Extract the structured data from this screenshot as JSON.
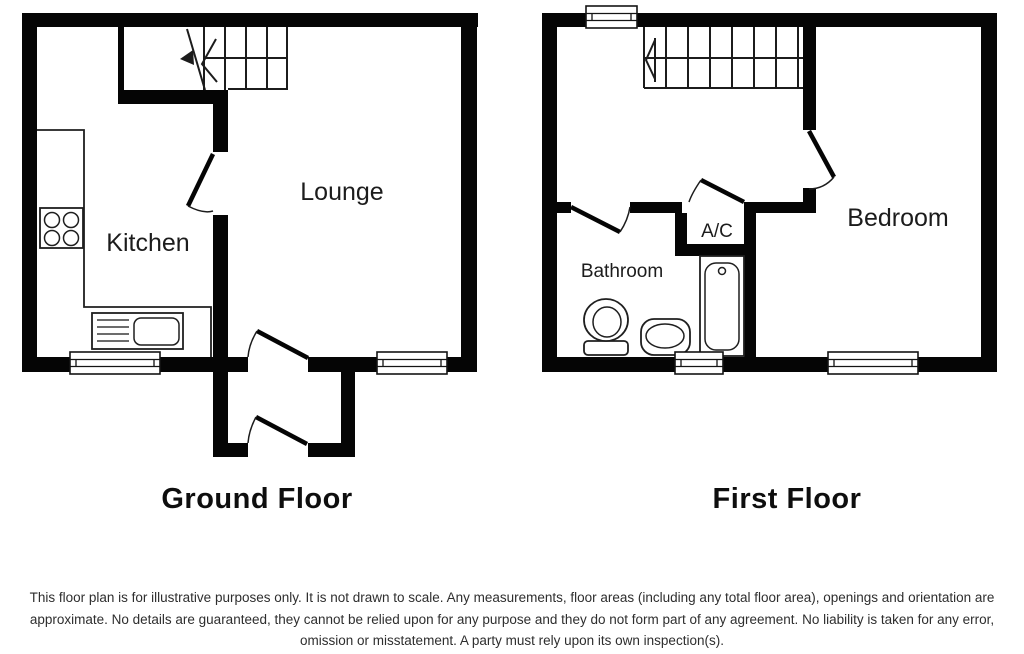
{
  "page": {
    "background": "#ffffff"
  },
  "colors": {
    "wall": "#050505",
    "line": "#1c1c1c",
    "label_text": "#1c1c1c",
    "disclaimer_text": "#2e2e2e"
  },
  "ground_floor": {
    "title": "Ground Floor",
    "labels": {
      "kitchen": "Kitchen",
      "lounge": "Lounge"
    },
    "icons": [
      "stairs-icon",
      "hob-icon",
      "sink-icon",
      "counter-icon",
      "window-icon",
      "door-swing-icon"
    ]
  },
  "first_floor": {
    "title": "First Floor",
    "labels": {
      "bathroom": "Bathroom",
      "ac": "A/C",
      "bedroom": "Bedroom"
    },
    "icons": [
      "stairs-icon",
      "toilet-icon",
      "basin-icon",
      "bathtub-icon",
      "window-icon",
      "door-swing-icon"
    ]
  },
  "disclaimer": {
    "lines": [
      "This floor plan is for illustrative purposes only. It is not drawn to scale. Any measurements, floor areas (including any total floor area), openings and orientation are",
      "approximate. No details are guaranteed, they cannot be relied upon for any purpose and they do not form part of any agreement. No liability is taken for any error,",
      "omission or misstatement. A party must rely upon its own inspection(s)."
    ]
  }
}
